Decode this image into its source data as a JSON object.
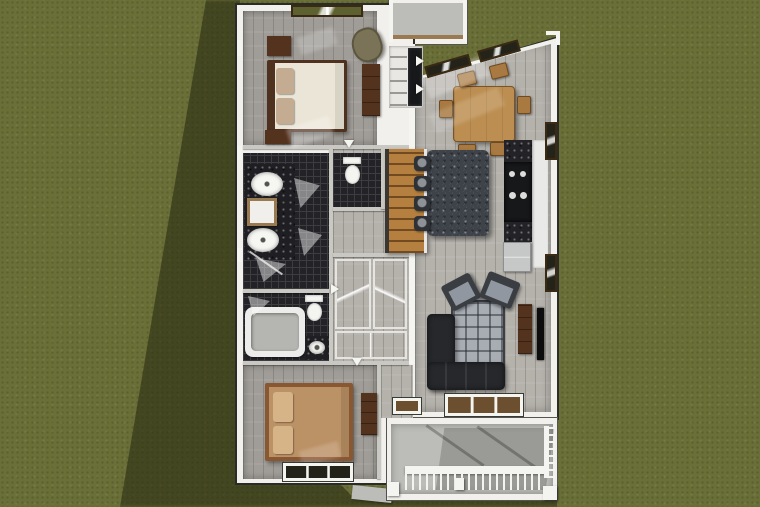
{
  "scene": {
    "type": "overhead-3d-floor-plan-render",
    "setting": "single-story house viewed from directly above on a grass lawn with cast shadow",
    "rooms": [
      "bedroom-1",
      "master-bathroom",
      "water-closet",
      "hall-bathroom",
      "hallway-closets",
      "bedroom-2",
      "entry-porch",
      "laundry-closet",
      "dining-area",
      "kitchen",
      "living-room",
      "staircase",
      "rear-covered-porch"
    ],
    "furniture": [
      "bed",
      "nightstands",
      "dresser",
      "armchair",
      "double-vanity-sinks",
      "shower-glass",
      "toilets",
      "bathtub",
      "dining-table",
      "dining-chairs",
      "kitchen-island",
      "bar-stools",
      "cooktop",
      "refrigerator",
      "counters",
      "sectional-sofa",
      "area-rug",
      "accent-chairs",
      "tv-console",
      "television",
      "porch-railing",
      "porch-posts"
    ]
  },
  "palette": {
    "grass": "#6a6e37",
    "shadow": "#2c3014",
    "wall": "#f1f0ec",
    "wall-edge": "#2b2b28",
    "partition": "#c9c8c2",
    "wood-light": "#b5b2ac",
    "wood-bedroom": "#a09d98",
    "tile-dark": "#232327",
    "tile-line": "#3c3c41",
    "stairs-wood": "#b5803f",
    "bed1-duvet": "#eae5d6",
    "bed1-frame": "#4f3120",
    "pillow-tan": "#c3ac92",
    "bed2-duvet": "#bb9166",
    "bed2-frame": "#8a5733",
    "pillow-tan2": "#d6b488",
    "dark-wood": "#53321e",
    "table-wood": "#bc8e51",
    "chair-wood": "#a87a42",
    "island-granite": "#3e434a",
    "stool": "#2e3236",
    "sofa": "#26282b",
    "rug": "#a8adb4",
    "rug-line": "#3c4046",
    "chair-gray": "#9097a0",
    "chair-dark": "#3a3d42",
    "counter-white": "#e9e9e7",
    "appliance-black": "#17181a",
    "fridge": "#c6c8c8",
    "porch-concrete": "#bcbcb8",
    "window-frame": "#3a2a14",
    "window-glass": "#5d6130",
    "window-dark": "#24231a",
    "white-trim": "#f4f4f0",
    "sill-tan": "#6b4f2e"
  }
}
